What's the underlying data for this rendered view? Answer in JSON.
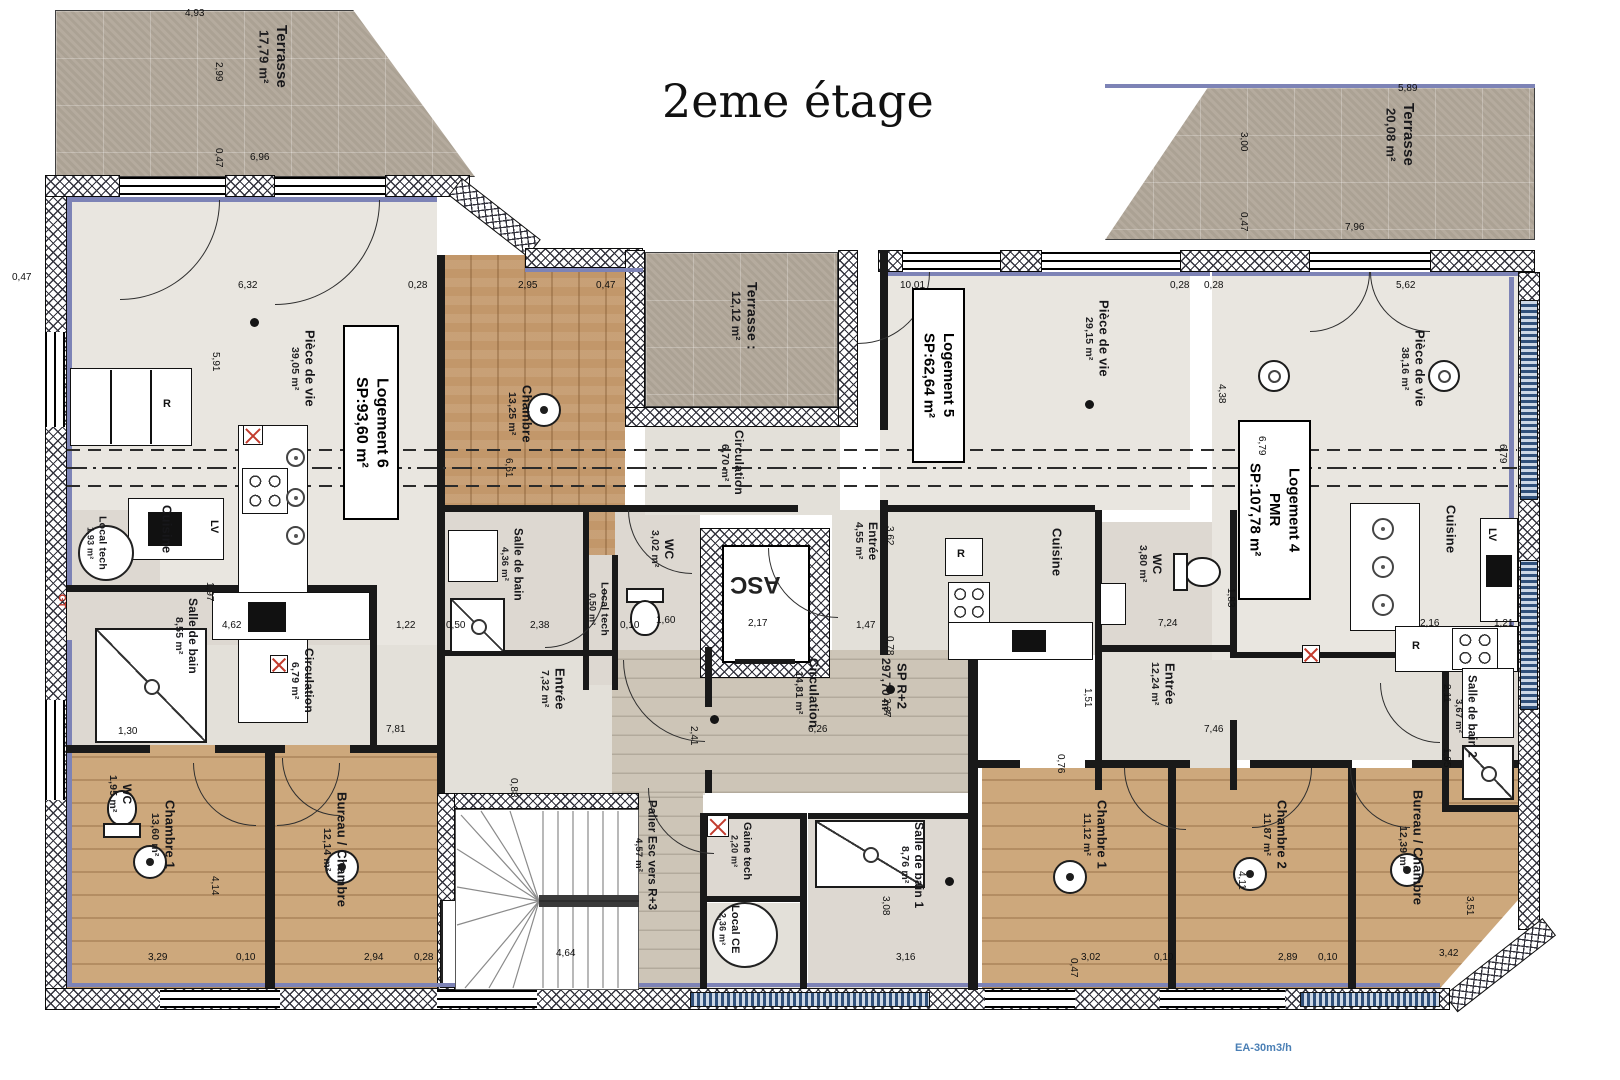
{
  "title": "2eme étage",
  "footer_note": "EA-30m3/h",
  "terraces": [
    {
      "name": "Terrasse",
      "area": "17,79 m²"
    },
    {
      "name": "Terrasse :",
      "area": "12,12 m²"
    },
    {
      "name": "Terrasse",
      "area": "20,08 m²"
    }
  ],
  "logements": [
    {
      "name": "Logement 6",
      "pmr": "",
      "sp": "SP:93,60 m²"
    },
    {
      "name": "Logement 5",
      "pmr": "",
      "sp": "SP:62,64 m²"
    },
    {
      "name": "Logement 4",
      "pmr": "PMR",
      "sp": "SP:107,78 m²"
    }
  ],
  "elevator": {
    "label": "ASC"
  },
  "rooms": [
    {
      "name": "Pièce de vie",
      "area": "39,05 m²"
    },
    {
      "name": "Cuisine",
      "area": ""
    },
    {
      "name": "Chambre",
      "area": "13,25 m²"
    },
    {
      "name": "Local tech",
      "area": "1,93 m²"
    },
    {
      "name": "Salle de bain",
      "area": "8,55 m²"
    },
    {
      "name": "WC",
      "area": "1,95 m²"
    },
    {
      "name": "Circulation",
      "area": "6,79 m²"
    },
    {
      "name": "Entrée",
      "area": "7,32 m²"
    },
    {
      "name": "Salle de bain",
      "area": "4,36 m²"
    },
    {
      "name": "Local tech",
      "area": "0,50 m²"
    },
    {
      "name": "WC",
      "area": "3,02 m²"
    },
    {
      "name": "Circulation",
      "area": "6,70 m²"
    },
    {
      "name": "Entrée",
      "area": "4,55 m²"
    },
    {
      "name": "Circulation",
      "area": "14,81 m²"
    },
    {
      "name": "SP R+2",
      "area": "297,70 m²"
    },
    {
      "name": "Pièce de vie",
      "area": "29,15 m²"
    },
    {
      "name": "Cuisine",
      "area": ""
    },
    {
      "name": "WC",
      "area": "3,80 m²"
    },
    {
      "name": "Entrée",
      "area": "12,24 m²"
    },
    {
      "name": "Pièce de vie",
      "area": "38,16 m²"
    },
    {
      "name": "Cuisine",
      "area": ""
    },
    {
      "name": "Salle de bain 2",
      "area": "3,67 m²"
    },
    {
      "name": "Chambre 1",
      "area": "13,60 m²"
    },
    {
      "name": "Bureau / Chambre",
      "area": "12,14 m²"
    },
    {
      "name": "Palier Esc vers R+3",
      "area": "4,57 m²"
    },
    {
      "name": "Gaine tech",
      "area": "2,20 m²"
    },
    {
      "name": "Local CE",
      "area": "2,36 m²"
    },
    {
      "name": "Salle de bain 1",
      "area": "8,76 m²"
    },
    {
      "name": "Chambre 1",
      "area": "11,12 m²"
    },
    {
      "name": "Chambre 2",
      "area": "11,87 m²"
    },
    {
      "name": "Bureau / Chambre",
      "area": "12,39 m²"
    }
  ],
  "fixtures": {
    "fridge": "R",
    "dishwasher": "LV",
    "duct": "GT"
  },
  "dims": [
    "4,93",
    "2,99",
    "0,47",
    "6,96",
    "0,47",
    "6,32",
    "0,28",
    "2,95",
    "0,47",
    "10,01",
    "0,28",
    "5,89",
    "3,00",
    "0,47",
    "7,96",
    "5,62",
    "0,28",
    "5,91",
    "6,61",
    "1,97",
    "4,62",
    "1,22",
    "0,50",
    "2,38",
    "0,10",
    "1,60",
    "2,17",
    "1,47",
    "3,62",
    "0,78",
    "7,24",
    "1,51",
    "0,76",
    "1,83",
    "2,16",
    "1,21",
    "4,38",
    "6,79",
    "6,79",
    "2,11",
    "1,95",
    "1,30",
    "7,81",
    "2,41",
    "6,26",
    "2,37",
    "7,46",
    "3,29",
    "0,10",
    "2,94",
    "0,28",
    "4,14",
    "4,64",
    "3,16",
    "3,08",
    "3,02",
    "0,10",
    "2,89",
    "0,10",
    "3,42",
    "3,51",
    "4,11",
    "0,47",
    "0,88"
  ]
}
